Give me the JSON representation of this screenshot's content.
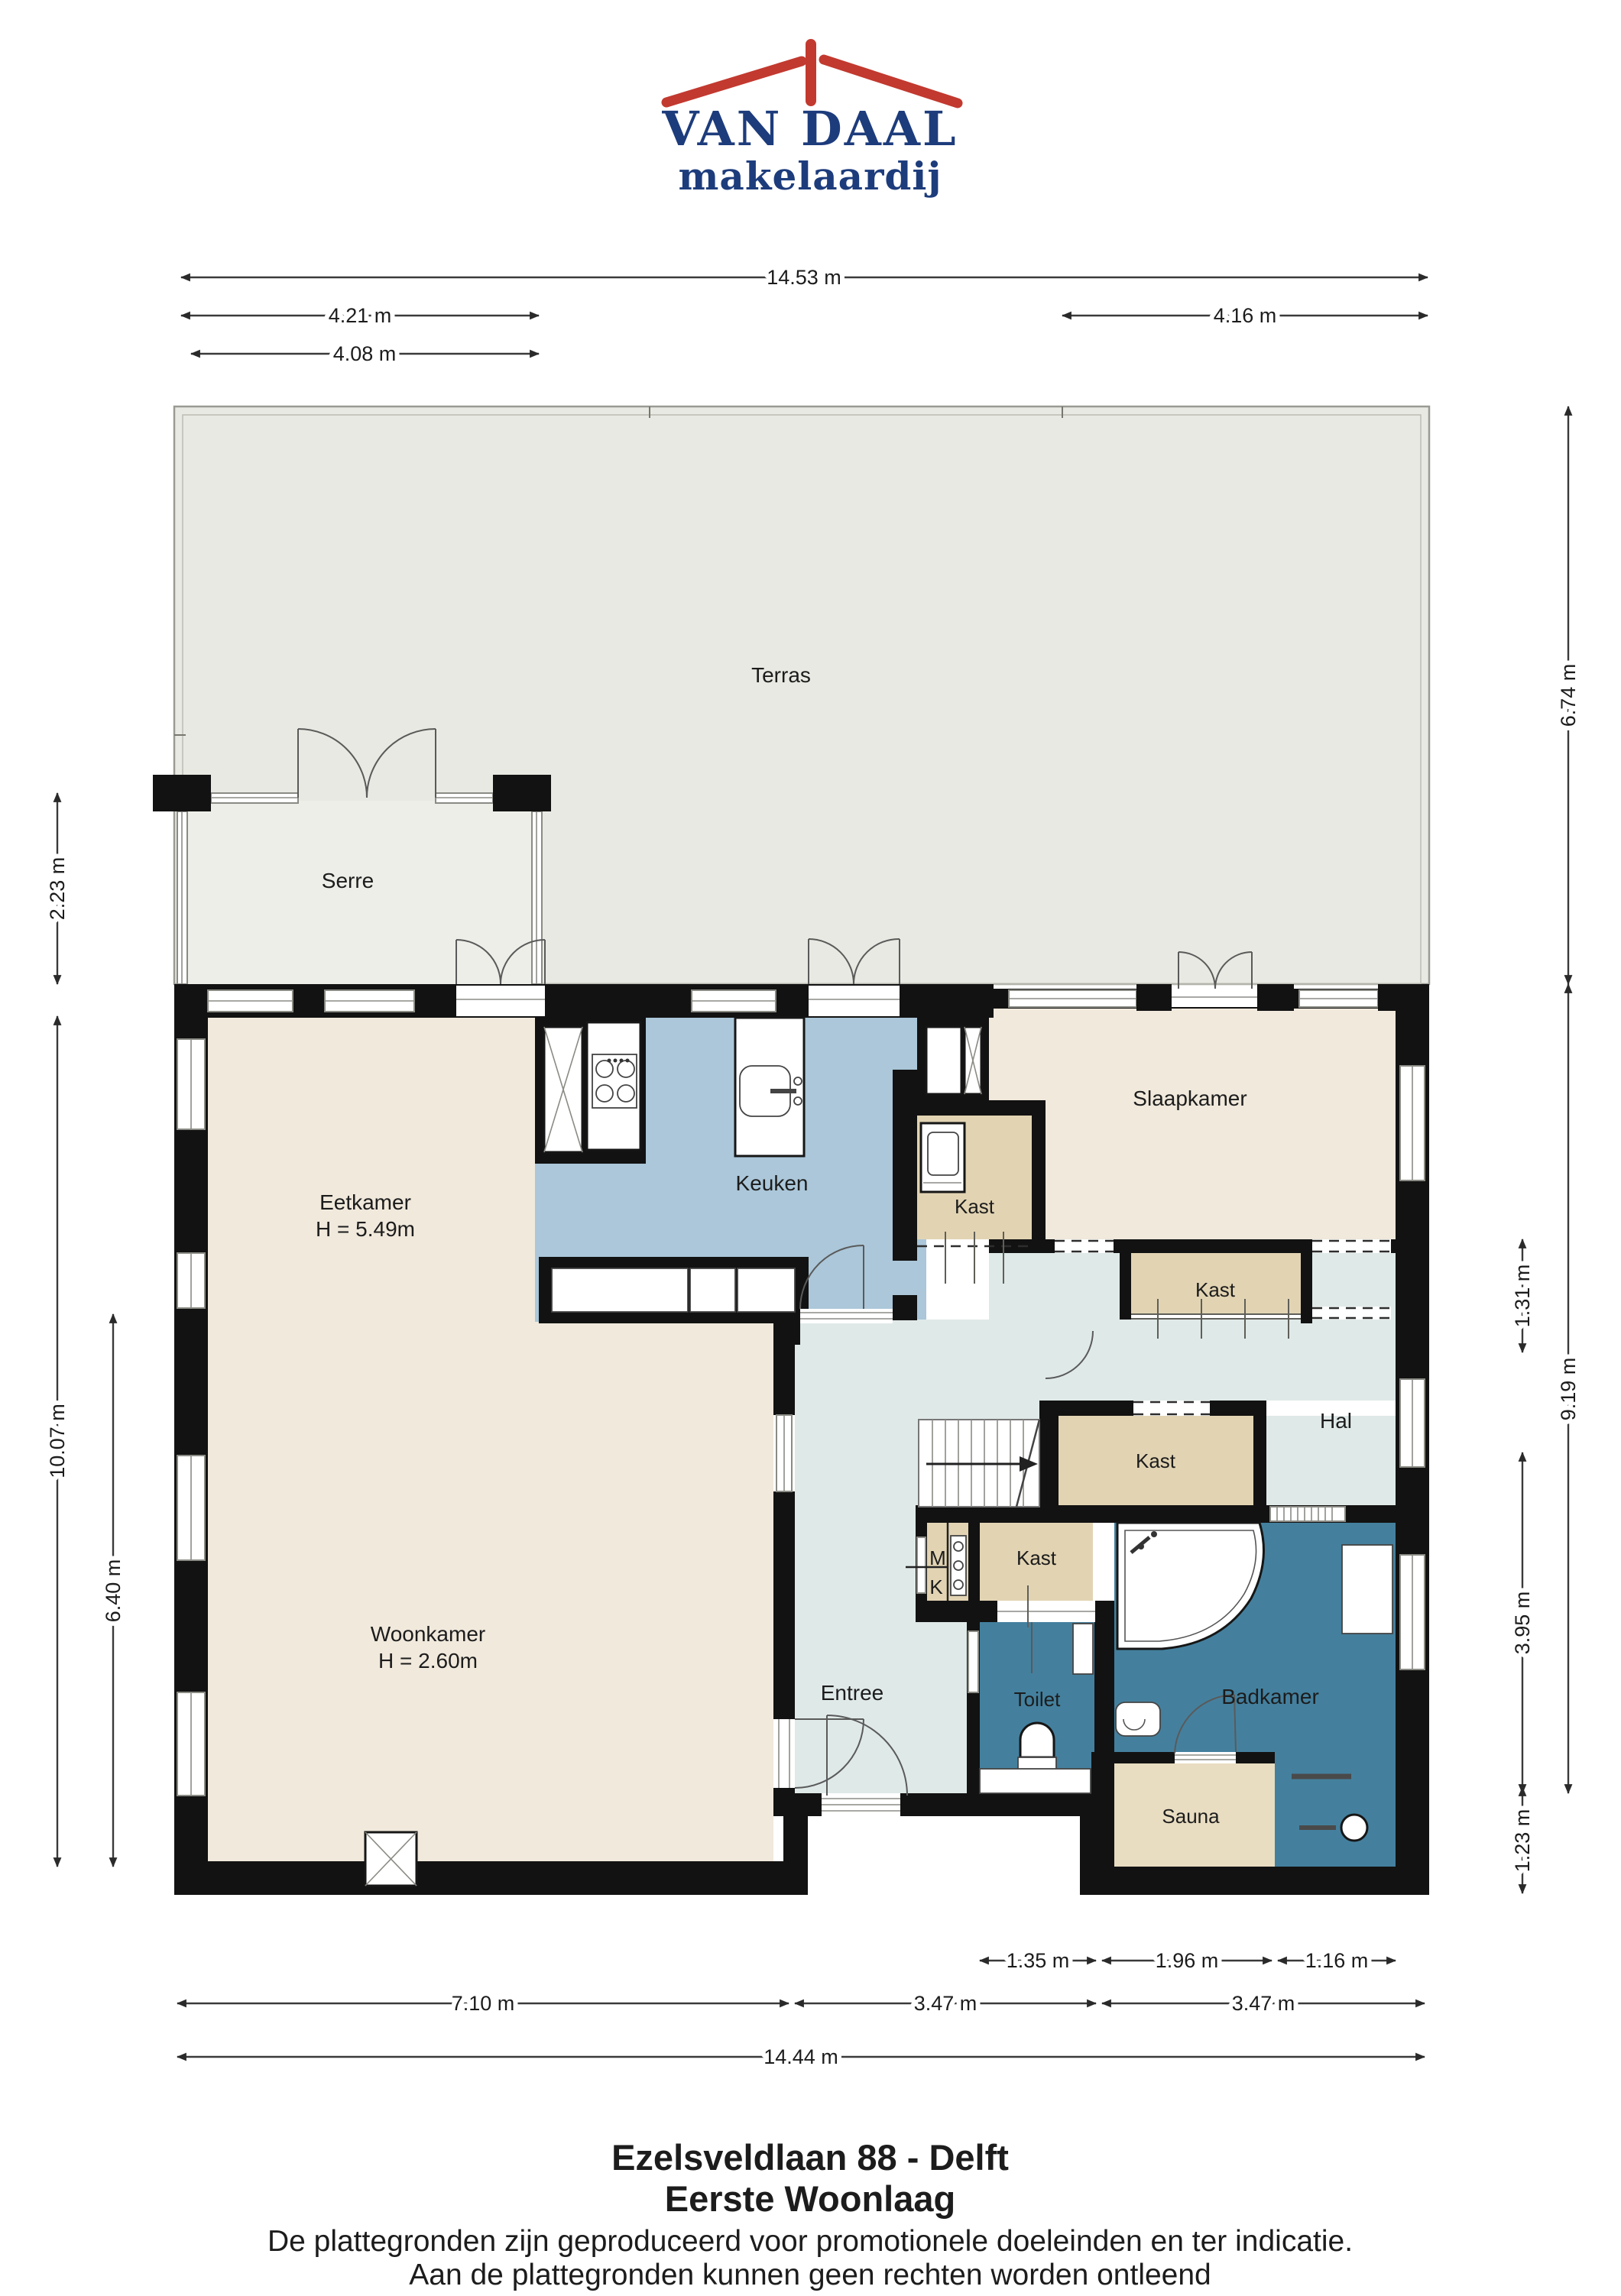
{
  "logo": {
    "name": "VAN DAAL",
    "tagline": "makelaardij"
  },
  "rooms": {
    "terras": "Terras",
    "serre": "Serre",
    "eetkamer": "Eetkamer",
    "eetkamer_height": "H = 5.49m",
    "keuken": "Keuken",
    "slaapkamer": "Slaapkamer",
    "kast": "Kast",
    "hal": "Hal",
    "woonkamer": "Woonkamer",
    "woonkamer_height": "H = 2.60m",
    "entree": "Entree",
    "toilet": "Toilet",
    "badkamer": "Badkamer",
    "sauna": "Sauna",
    "meter_m": "M",
    "meter_k": "K"
  },
  "dimensions": {
    "top": [
      "14.53 m",
      "4.21 m",
      "4.16 m",
      "4.08 m"
    ],
    "left": [
      "2.23 m",
      "10.07 m",
      "6.40 m"
    ],
    "right": [
      "6.74 m",
      "9.19 m",
      "1.31 m",
      "3.95 m",
      "1.23 m"
    ],
    "bottom": [
      "1.35 m",
      "1.96 m",
      "1.16 m",
      "7.10 m",
      "3.47 m",
      "3.47 m",
      "14.44 m"
    ]
  },
  "footer": {
    "title": "Ezelsveldlaan 88 - Delft",
    "subtitle": "Eerste Woonlaag",
    "disclaimer1": "De plattegronden zijn geproduceerd voor promotionele doeleinden en ter indicatie.",
    "disclaimer2": "Aan de plattegronden kunnen geen rechten worden ontleend"
  },
  "colors": {
    "wall": "#121212",
    "terras": "#e8e9e2",
    "serre": "#edeee8",
    "living_cream": "#f0e9dc",
    "kitchen_blue": "#abc7d9",
    "hall_blue": "#dfe9e8",
    "bath_teal": "#44809e",
    "closet_tan": "#e2d4b3",
    "sauna_tan": "#e8dcc1",
    "logo_navy": "#1d3c7c",
    "logo_red": "#c2392f"
  }
}
